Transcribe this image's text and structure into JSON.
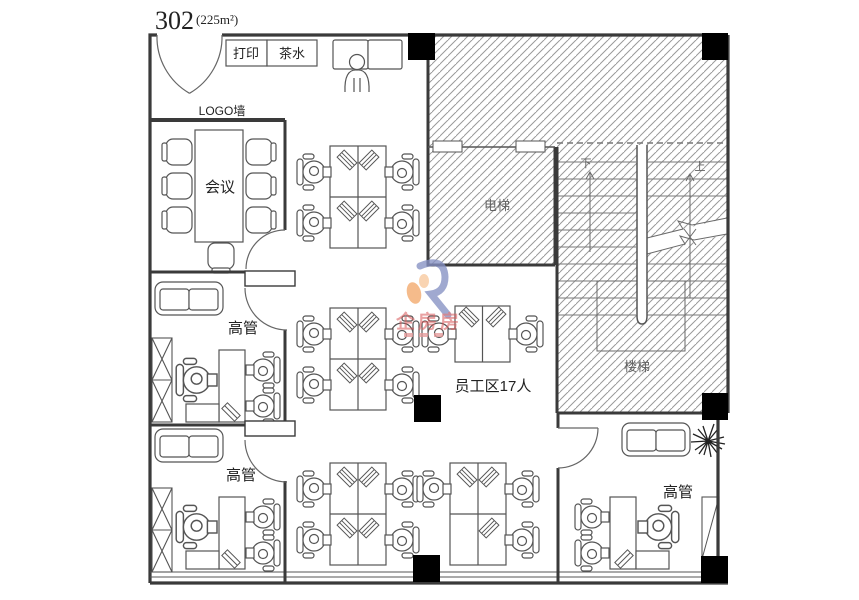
{
  "title": {
    "unit": "302",
    "area": "(225m²)"
  },
  "labels": {
    "print": "打印",
    "tea": "茶水",
    "logo_wall": "LOGO墙",
    "meeting": "会议",
    "exec_office_1": "高管",
    "exec_office_2": "高管",
    "exec_office_3": "高管",
    "elevator": "电梯",
    "staircase": "楼梯",
    "stair_down": "下",
    "stair_up": "上",
    "staff_area": "员工区17人"
  },
  "watermark": {
    "brand": "企房房"
  },
  "colors": {
    "wall": "#3a3a3a",
    "furniture": "#555555",
    "hatch": "#9a9a9a",
    "column": "#000000",
    "watermark_red": "#d9595a",
    "watermark_blue": "#8691c4",
    "watermark_orange": "#f3a96b",
    "background": "#ffffff"
  }
}
